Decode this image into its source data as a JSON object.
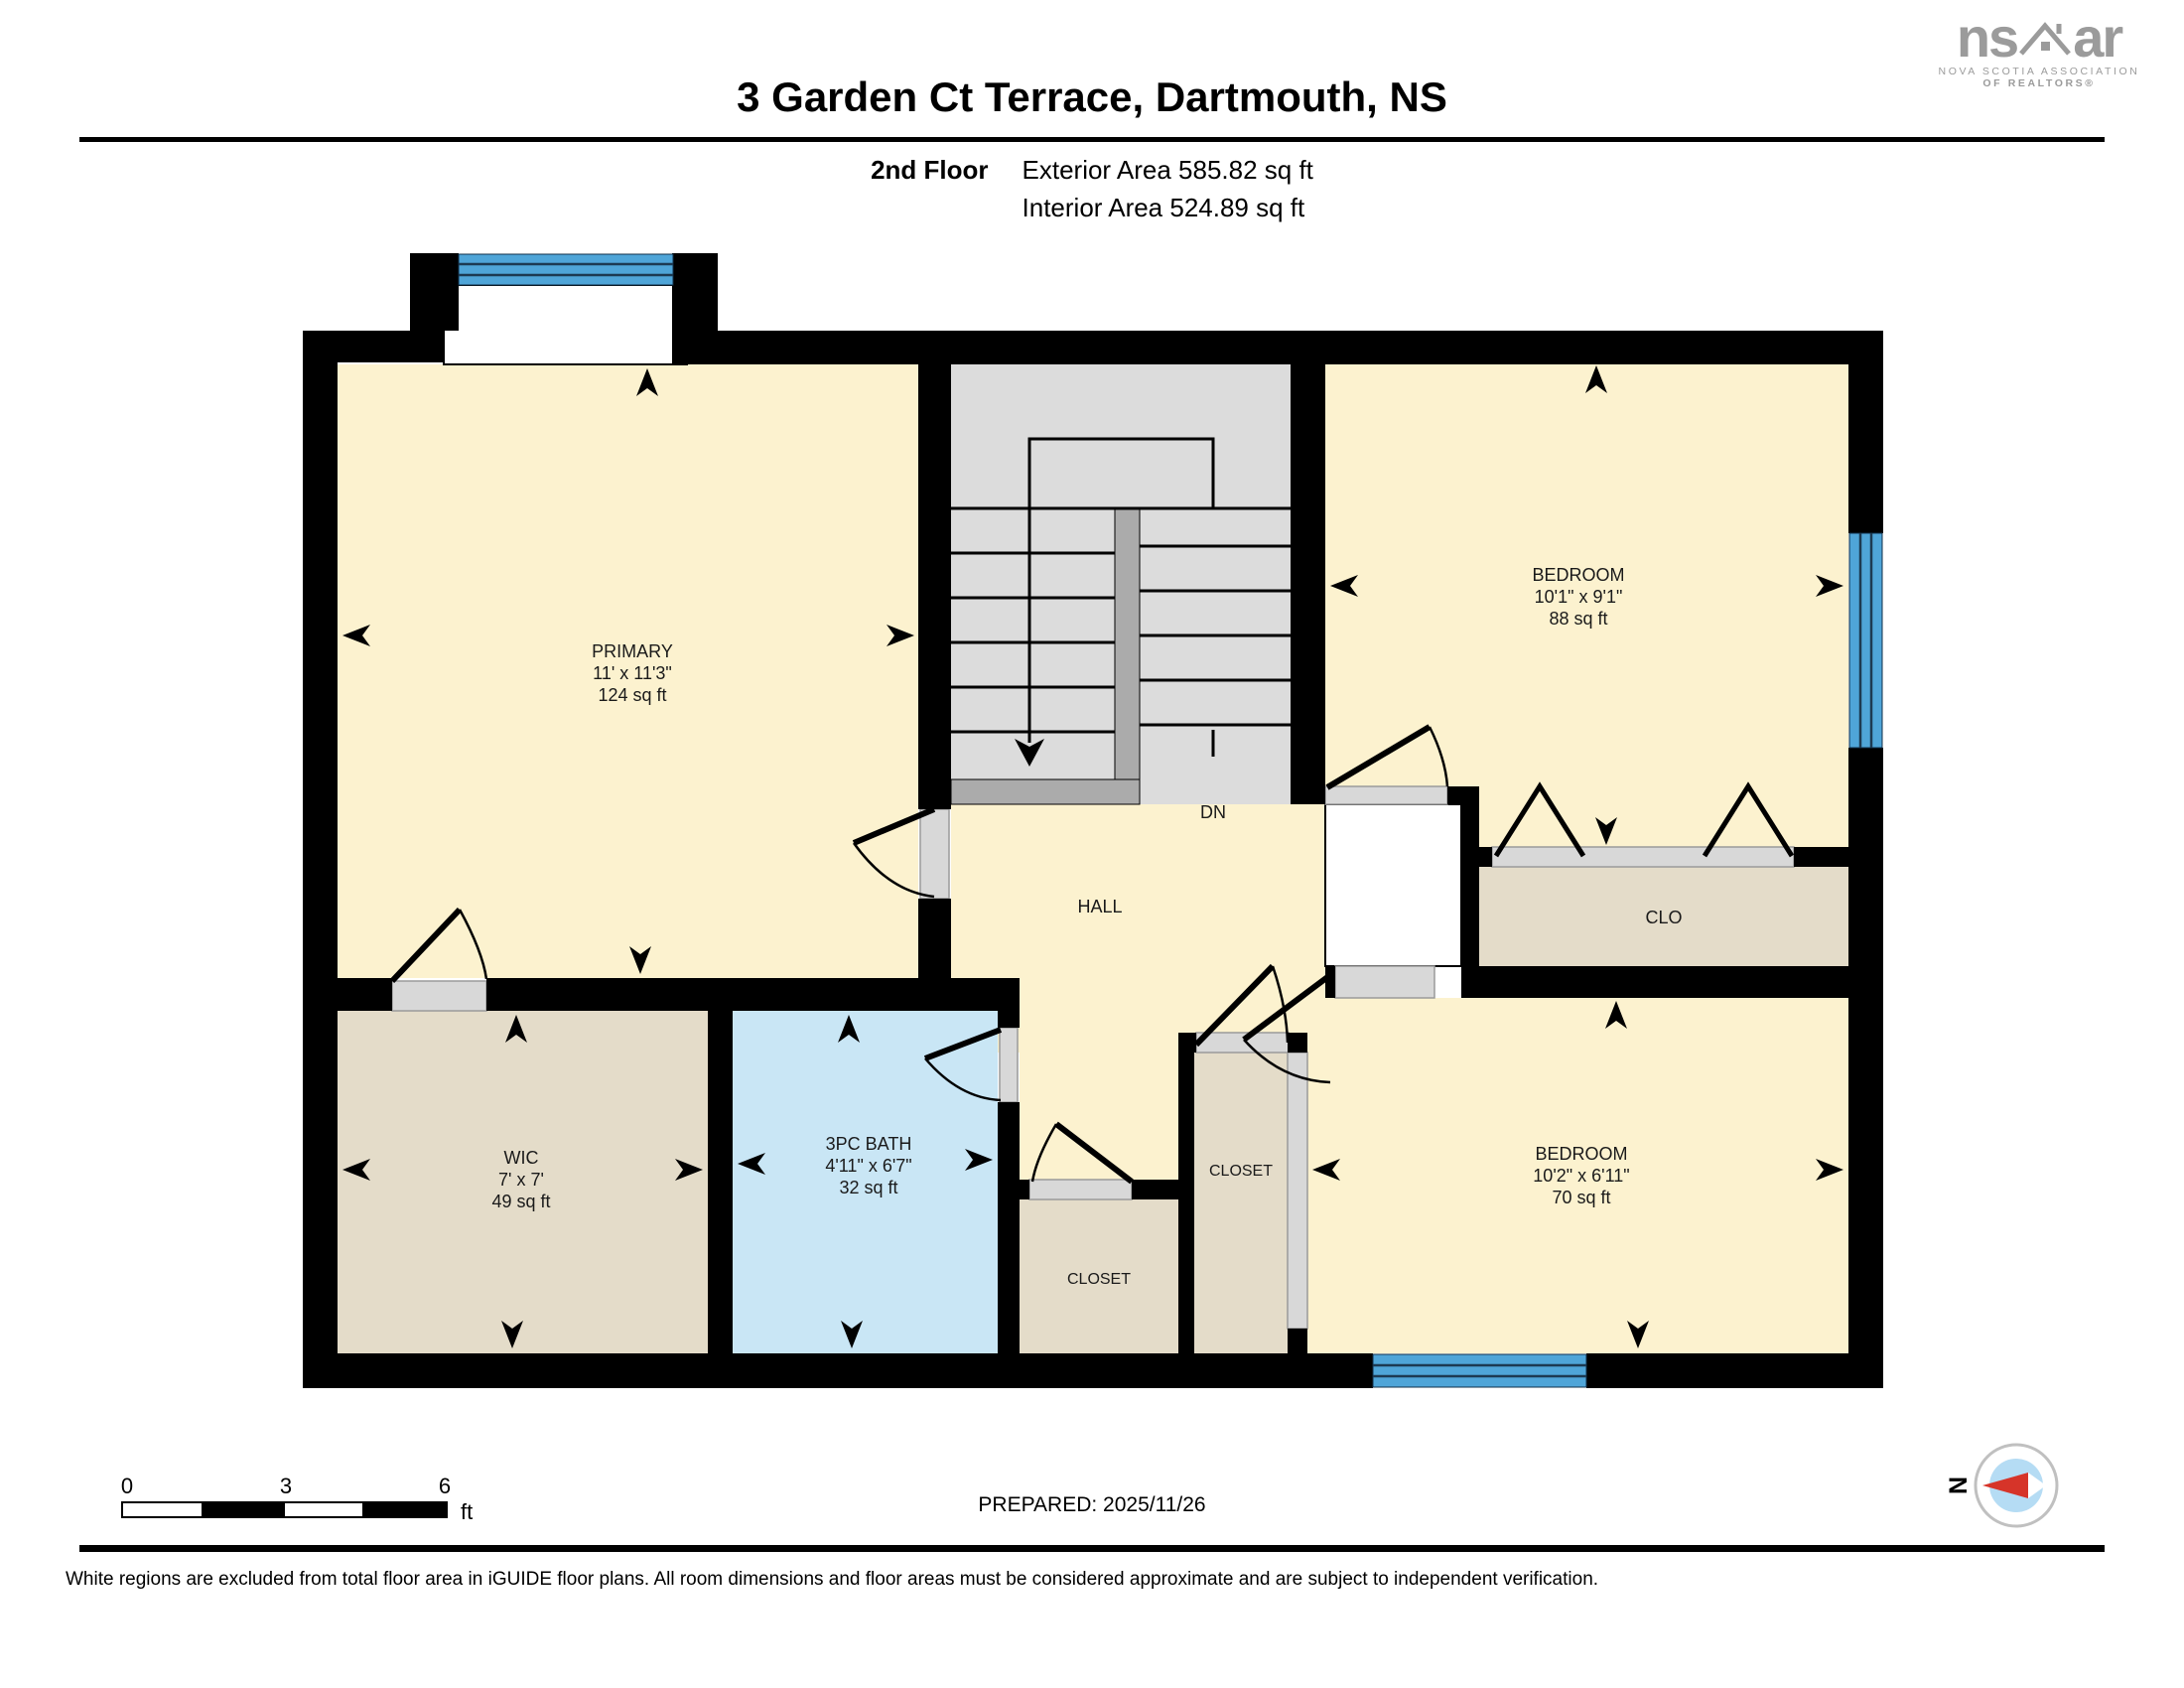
{
  "header": {
    "title": "3 Garden Ct Terrace, Dartmouth, NS",
    "floor_label": "2nd Floor",
    "exterior_area": "Exterior Area 585.82 sq ft",
    "interior_area": "Interior Area 524.89 sq ft"
  },
  "logo": {
    "name_left": "ns",
    "name_right": "ar",
    "tagline_line1": "NOVA SCOTIA ASSOCIATION",
    "tagline_line2": "OF REALTORS®"
  },
  "rooms": {
    "primary": {
      "name": "PRIMARY",
      "dims": "11' x 11'3\"",
      "area": "124 sq ft"
    },
    "bedroom1": {
      "name": "BEDROOM",
      "dims": "10'1\" x 9'1\"",
      "area": "88 sq ft"
    },
    "wic": {
      "name": "WIC",
      "dims": "7' x 7'",
      "area": "49 sq ft"
    },
    "bath": {
      "name": "3PC BATH",
      "dims": "4'11\" x 6'7\"",
      "area": "32 sq ft"
    },
    "bedroom2": {
      "name": "BEDROOM",
      "dims": "10'2\" x 6'11\"",
      "area": "70 sq ft"
    },
    "hall": {
      "name": "HALL"
    },
    "clo": {
      "name": "CLO"
    },
    "closet1": {
      "name": "CLOSET"
    },
    "closet2": {
      "name": "CLOSET"
    },
    "stairs": {
      "label": "DN"
    }
  },
  "scale_bar": {
    "tick0": "0",
    "tick1": "3",
    "tick2": "6",
    "unit": "ft"
  },
  "compass": {
    "label": "N"
  },
  "footer": {
    "prepared": "PREPARED: 2025/11/26",
    "disclaimer": "White regions are excluded from total floor area in iGUIDE floor plans. All room dimensions and floor areas must be considered approximate and are subject to independent verification."
  },
  "colors": {
    "wall": "#000000",
    "cream": "#FCF2CF",
    "tan": "#E4DCC9",
    "bath": "#C9E6F5",
    "win": "#4FA5D8",
    "sgray": "#DCDCDC",
    "sdark": "#ABABAB",
    "thresh": "#D8D8D8",
    "logo": "#9B9B9B",
    "compass_red": "#D63429",
    "compass_blue": "#B5DCF4"
  }
}
